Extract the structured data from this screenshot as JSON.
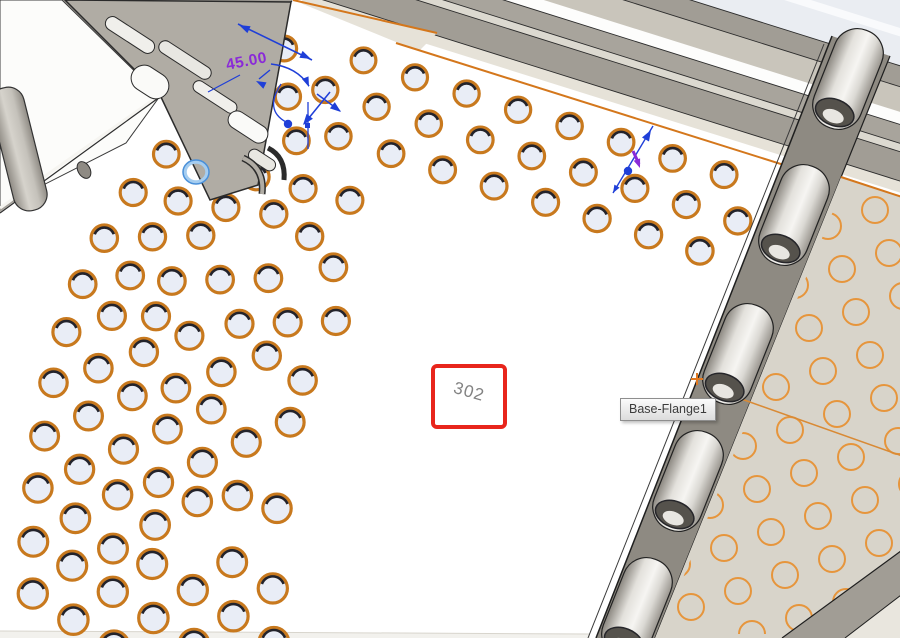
{
  "viewport": {
    "description": "CAD 3D viewport showing a sheet-metal tray with a curved hole pattern, hinge knuckles and a flat-pattern preview"
  },
  "annotations": {
    "dimension_value": "45.00",
    "target_box_label": "302",
    "tooltip_text": "Base-Flange1",
    "plus_marker": "+"
  },
  "colors": {
    "face_white": "#ffffff",
    "hole_rim": "#c8791e",
    "hole_fill": "#e9edf6",
    "hole_shadow": "#23232b",
    "preview_circle": "#e6953c",
    "edge_highlight": "#d4771c",
    "fold_line": "#d98a35",
    "dimension_blue": "#1f3fd8",
    "dimension_purple": "#8a2ad8",
    "selection_blue": "#4a90d9",
    "selection_halo": "#a5cdf0",
    "wall_gray": "#a5a19a",
    "band_dark": "#a19d95",
    "band_dark2": "#a8a49c",
    "band_mid": "#c9c5bb",
    "band_light": "#dcd9d0",
    "edge_beige": "#e6e2d8",
    "lid_light": "#eaedf2",
    "panel_beige": "#d8d4ca",
    "strip_dark": "#8e8a82",
    "hinge_edge": "#222222",
    "bracket_gray": "#b0aca4",
    "red_box": "#e8251c",
    "box_label_gray": "#828282",
    "tooltip_text_color": "#3c3c3c",
    "outline_dark": "#2c2c2c"
  },
  "hole_pattern": {
    "row_count": 7,
    "row_spacing": 40,
    "spacing": 54,
    "first_offset": 20,
    "stagger": 27,
    "radius_base": 12.2,
    "radius_slope": 0.004,
    "min_dist": 37
  },
  "preview_pattern": {
    "radius": 13,
    "u": [
      47,
      -16
    ],
    "v": [
      14,
      43
    ]
  }
}
